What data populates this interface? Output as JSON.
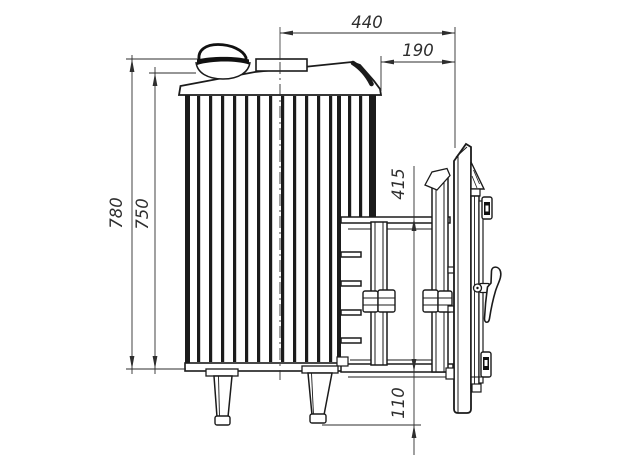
{
  "drawing": {
    "title": "wood-burning sauna stove side view technical drawing",
    "background": "#ffffff",
    "line_color": "#1b1b1b",
    "dim_color": "#2e2e2e",
    "dimensions": {
      "chimney_axis_to_door_front": "440",
      "tunnel_extension": "190",
      "height_to_damper_top": "780",
      "height_to_body_top": "750",
      "tunnel_opening_height": "415",
      "tunnel_bottom_clearance": "110"
    }
  }
}
